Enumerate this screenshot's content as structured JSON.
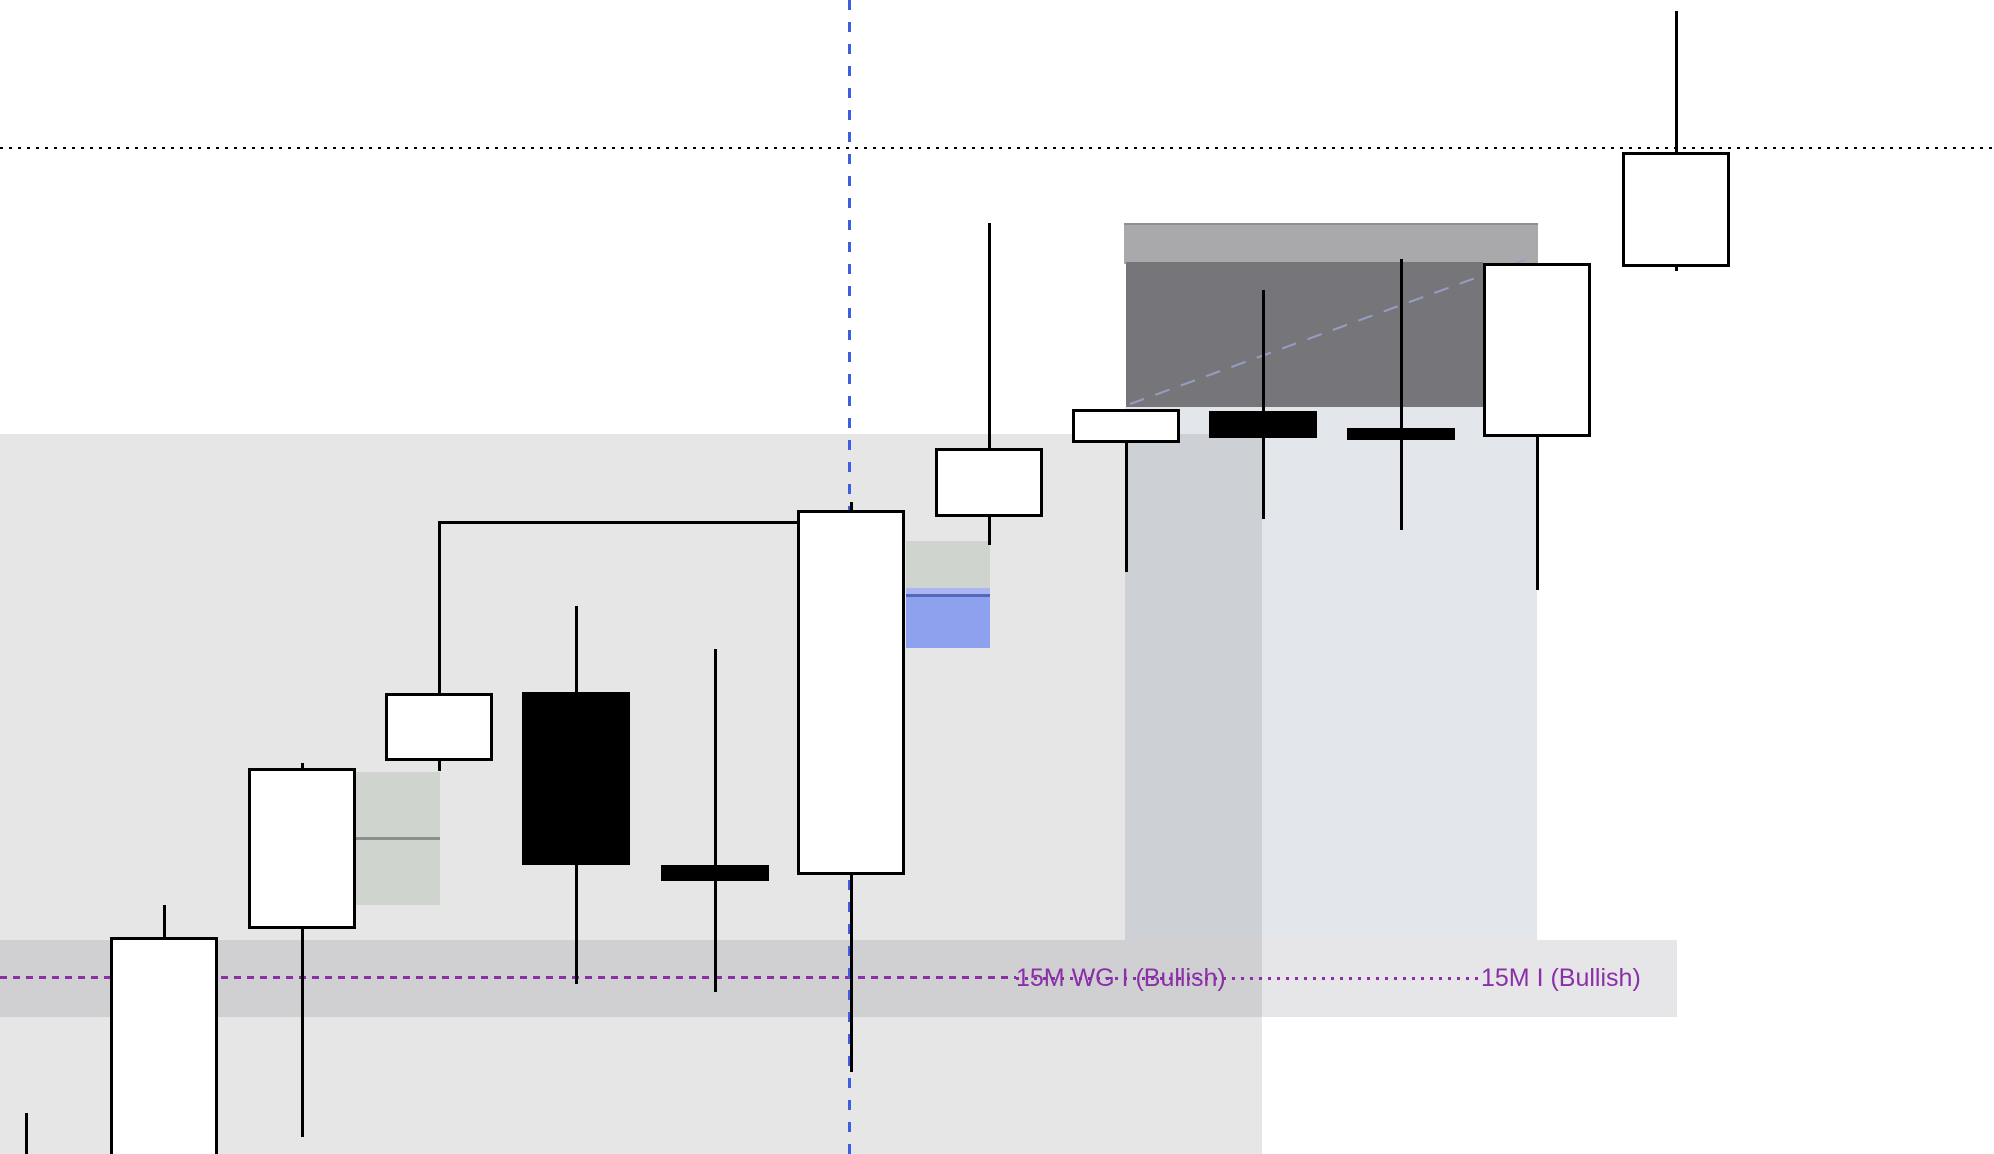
{
  "canvas": {
    "width": 1994,
    "height": 1154,
    "background": "#ffffff"
  },
  "labels": {
    "wg_label": "15M WG I (Bullish)",
    "i_label": "15M I (Bullish)",
    "text_color": "#8b2fa8"
  },
  "chart_data": {
    "type": "candlestick",
    "title": "",
    "axes_visible": false,
    "coordinate_units": "pixels (no price/time scale visible in screenshot)",
    "body_width": 108,
    "wick_width": 3,
    "body_border_width": 3,
    "up_color": "#ffffff",
    "down_color": "#000000",
    "wick_color": "#000000",
    "candles": [
      {
        "id": "c0-partial-left-edge",
        "x": 26,
        "high": 1113,
        "low": 1160,
        "body_top": null,
        "body_bottom": null,
        "direction": "partial"
      },
      {
        "id": "c1",
        "x": 164,
        "high": 905,
        "low": 1160,
        "body_top": 937,
        "body_bottom": 1160,
        "direction": "up"
      },
      {
        "id": "c2",
        "x": 302,
        "high": 763,
        "low": 1137,
        "body_top": 768,
        "body_bottom": 929,
        "direction": "up"
      },
      {
        "id": "c3",
        "x": 439,
        "high": 523,
        "low": 771,
        "body_top": 693,
        "body_bottom": 761,
        "direction": "up"
      },
      {
        "id": "c4",
        "x": 576,
        "high": 606,
        "low": 984,
        "body_top": 692,
        "body_bottom": 865,
        "direction": "down"
      },
      {
        "id": "c5",
        "x": 715,
        "high": 649,
        "low": 992,
        "body_top": 865,
        "body_bottom": 881,
        "direction": "down"
      },
      {
        "id": "c6",
        "x": 851,
        "high": 502,
        "low": 1072,
        "body_top": 510,
        "body_bottom": 875,
        "direction": "up"
      },
      {
        "id": "c7",
        "x": 989,
        "high": 223,
        "low": 545,
        "body_top": 448,
        "body_bottom": 517,
        "direction": "up"
      },
      {
        "id": "c8",
        "x": 1126,
        "high": 409,
        "low": 572,
        "body_top": 409,
        "body_bottom": 443,
        "direction": "up"
      },
      {
        "id": "c9",
        "x": 1263,
        "high": 290,
        "low": 519,
        "body_top": 411,
        "body_bottom": 438,
        "direction": "down"
      },
      {
        "id": "c10",
        "x": 1401,
        "high": 259,
        "low": 530,
        "body_top": 428,
        "body_bottom": 440,
        "direction": "down"
      },
      {
        "id": "c11",
        "x": 1537,
        "high": 263,
        "low": 590,
        "body_top": 263,
        "body_bottom": 437,
        "direction": "up"
      },
      {
        "id": "c12",
        "x": 1676,
        "high": 11,
        "low": 271,
        "body_top": 152,
        "body_bottom": 267,
        "direction": "up"
      }
    ],
    "zones": [
      {
        "id": "demand-zone-left",
        "x": 0,
        "y": 434,
        "w": 1262,
        "h": 726,
        "fill": "rgba(0,0,0,0.098)"
      },
      {
        "id": "demand-zone-right",
        "x": 1125,
        "y": 407,
        "w": 412,
        "h": 533,
        "fill": "rgba(40,60,100,0.13)"
      },
      {
        "id": "signal-band",
        "x": 0,
        "y": 940,
        "w": 1677,
        "h": 77,
        "fill": "rgba(40,40,60,0.116)"
      },
      {
        "id": "supply-band-light",
        "x": 1124,
        "y": 223,
        "w": 414,
        "h": 39,
        "fill": "#a9a9ab",
        "border_top": "2px solid #8f8f93"
      },
      {
        "id": "supply-box-dark",
        "x": 1126,
        "y": 262,
        "w": 357,
        "h": 145,
        "fill": "#76767a"
      },
      {
        "id": "fvg-box-left-upper",
        "x": 356,
        "y": 772,
        "w": 84,
        "h": 65,
        "fill": "#cfd4cf"
      },
      {
        "id": "fvg-box-divider",
        "x": 356,
        "y": 837,
        "w": 84,
        "h": 3,
        "fill": "#8a908b"
      },
      {
        "id": "fvg-box-left-lower",
        "x": 356,
        "y": 840,
        "w": 84,
        "h": 65,
        "fill": "#cfd4cf"
      },
      {
        "id": "fvg-box-right",
        "x": 906,
        "y": 541,
        "w": 84,
        "h": 47,
        "fill": "#cfd4cf"
      },
      {
        "id": "ifvg-strip-light",
        "x": 906,
        "y": 588,
        "w": 84,
        "h": 6,
        "fill": "#a9b6f2"
      },
      {
        "id": "ifvg-line-navy",
        "x": 906,
        "y": 594,
        "w": 84,
        "h": 3,
        "fill": "#5568b8"
      },
      {
        "id": "ifvg-box-blue",
        "x": 906,
        "y": 597,
        "w": 84,
        "h": 51,
        "fill": "#8da1ef"
      }
    ],
    "lines": [
      {
        "id": "dotted-level-top",
        "orient": "h",
        "y": 148,
        "x1": 0,
        "x2": 1994,
        "color": "#000000",
        "style": "dotted",
        "thickness": 2,
        "dash": 3,
        "gap": 6
      },
      {
        "id": "purple-dashed-line",
        "orient": "h",
        "y": 977,
        "x1": 0,
        "x2": 1016,
        "color": "#8b2fa8",
        "style": "dashed",
        "thickness": 3,
        "dash": 7,
        "gap": 6
      },
      {
        "id": "purple-dotted-line",
        "orient": "h",
        "y": 978,
        "x1": 1016,
        "x2": 1481,
        "color": "#8b2fa8",
        "style": "dotted",
        "thickness": 3,
        "dash": 3,
        "gap": 6
      },
      {
        "id": "structure-ray",
        "orient": "h",
        "y": 522,
        "x1": 438,
        "x2": 800,
        "color": "#000000",
        "style": "solid",
        "thickness": 3
      },
      {
        "id": "session-vline-blue",
        "orient": "v",
        "x": 849,
        "y1": 0,
        "y2": 1154,
        "color": "#3b5fe0",
        "style": "dashed",
        "thickness": 3,
        "dash": 10,
        "gap": 12
      },
      {
        "id": "trend-diagonal",
        "orient": "diag",
        "x1": 1130,
        "y1": 404,
        "x2": 1533,
        "y2": 257,
        "color": "#969dc2",
        "style": "dashed",
        "thickness": 2,
        "dash": 15,
        "gap": 12
      }
    ]
  }
}
